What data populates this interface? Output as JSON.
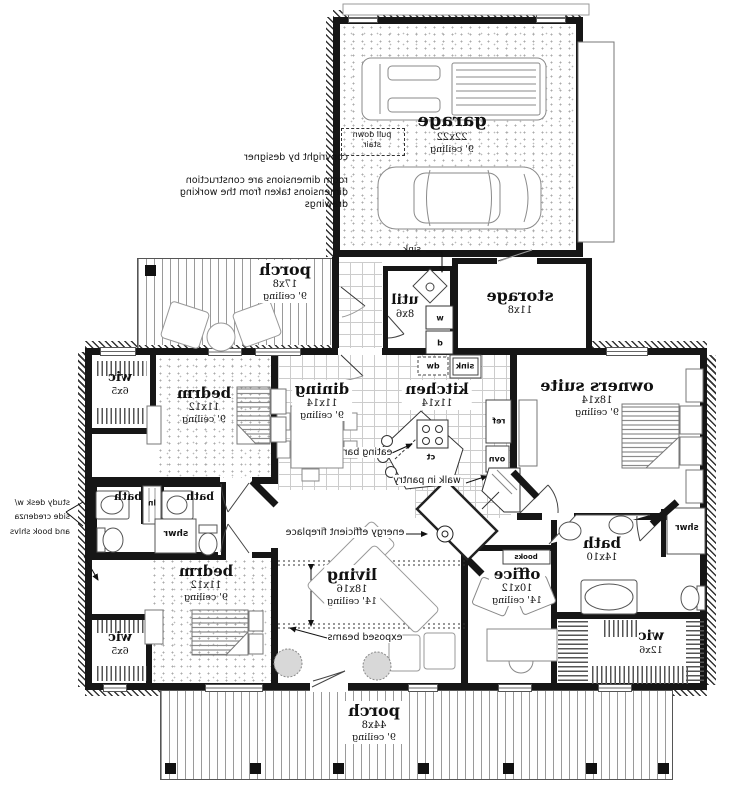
{
  "annotations": {
    "copyright": "copyright by designer",
    "note1": "room dimensions are construction",
    "note2": "dimensions taken from the working",
    "note3": "drawings",
    "pull_down_1": "pull down",
    "pull_down_2": "stair",
    "sink_leader": "sink",
    "eating_bar": "eating bar",
    "walk_in_pantry": "walk in pantry",
    "fireplace": "energy efficient fireplace",
    "exposed_beams": "exposed beams",
    "study_1": "study desk w/",
    "study_2": "side credenza",
    "study_3": "and book shlvs",
    "books": "books"
  },
  "fixtures": {
    "washer": "w",
    "dryer": "d",
    "dishwasher": "dw",
    "sink": "sink",
    "fridge": "ref",
    "oven": "ovn",
    "cooktop": "ct",
    "linen": "ln",
    "shower_small": "shwr",
    "shower_master": "shwr"
  },
  "rooms": {
    "garage": {
      "name": "garage",
      "size": "22x22",
      "ceiling": "9' ceiling"
    },
    "porch_side": {
      "name": "porch",
      "size": "17x8",
      "ceiling": "9' ceiling"
    },
    "storage": {
      "name": "storage",
      "size": "11x8"
    },
    "util": {
      "name": "util",
      "size": "8x6"
    },
    "wic_top": {
      "name": "wic",
      "size": "6x5"
    },
    "bedrm_top": {
      "name": "bedrm",
      "size": "11x12",
      "ceiling": "9' ceiling"
    },
    "dining": {
      "name": "dining",
      "size": "11x14",
      "ceiling": "9' ceiling"
    },
    "kitchen": {
      "name": "kitchen",
      "size": "11x14"
    },
    "owners_suite": {
      "name": "owners suite",
      "size": "18x14",
      "ceiling": "9' ceiling"
    },
    "bath_left": {
      "name": "bath"
    },
    "bath_mid": {
      "name": "bath"
    },
    "bedrm_bottom": {
      "name": "bedrm",
      "size": "11x12",
      "ceiling": "9' ceiling"
    },
    "wic_bottom": {
      "name": "wic",
      "size": "6x5"
    },
    "living": {
      "name": "living",
      "size": "18x16",
      "ceiling": "14' ceiling"
    },
    "office": {
      "name": "office",
      "size": "10x12",
      "ceiling": "14' ceiling"
    },
    "bath_main": {
      "name": "bath",
      "size": "14x10"
    },
    "wic_main": {
      "name": "wic",
      "size": "12x6"
    },
    "porch_front": {
      "name": "porch",
      "size": "44x8",
      "ceiling": "9' ceiling"
    }
  }
}
